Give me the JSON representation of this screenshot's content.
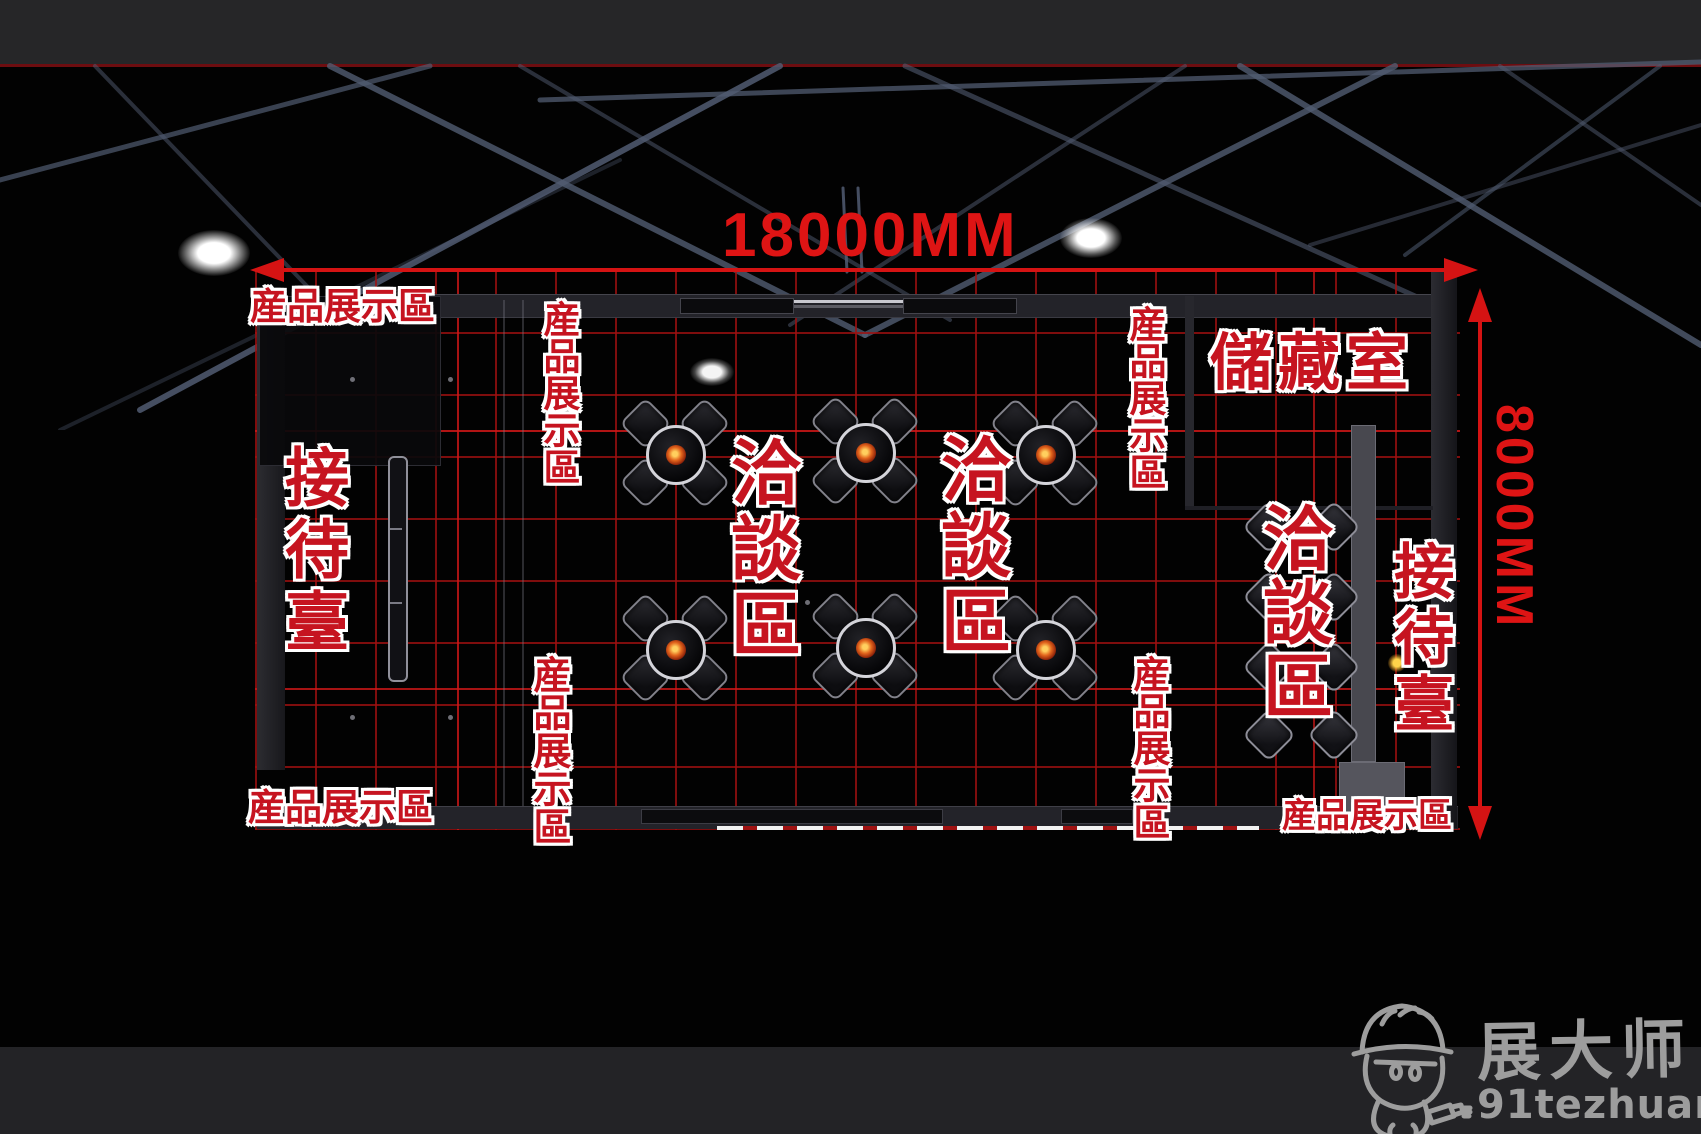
{
  "dimensions": {
    "width_label": "18000MM",
    "height_label": "8000MM"
  },
  "area_labels": [
    {
      "id": "product-display-top-left",
      "text": "産品展示區",
      "orientation": "horizontal"
    },
    {
      "id": "product-display-left-top",
      "text": "産品展示區",
      "orientation": "vertical"
    },
    {
      "id": "product-display-left-bottom",
      "text": "産品展示區",
      "orientation": "vertical"
    },
    {
      "id": "product-display-bottom-left",
      "text": "産品展示區",
      "orientation": "horizontal"
    },
    {
      "id": "product-display-right-top",
      "text": "産品展示區",
      "orientation": "vertical"
    },
    {
      "id": "product-display-right-bottom",
      "text": "産品展示區",
      "orientation": "vertical"
    },
    {
      "id": "product-display-bottom-right",
      "text": "産品展示區",
      "orientation": "horizontal"
    },
    {
      "id": "reception-desk-left",
      "text": "接待臺",
      "orientation": "vertical"
    },
    {
      "id": "reception-desk-right",
      "text": "接待臺",
      "orientation": "vertical"
    },
    {
      "id": "negotiation-area-1",
      "text": "洽談區",
      "orientation": "vertical"
    },
    {
      "id": "negotiation-area-2",
      "text": "洽談區",
      "orientation": "vertical"
    },
    {
      "id": "negotiation-area-3",
      "text": "洽談區",
      "orientation": "vertical"
    },
    {
      "id": "storage-room",
      "text": "儲藏室",
      "orientation": "horizontal"
    }
  ],
  "watermark": {
    "brand": "展大师",
    "site": "91tezhuang.com"
  },
  "colors": {
    "label_red": "#c61420",
    "label_outline": "#ffffff",
    "dimension_red": "#d51313",
    "grid_red": "#9e1010",
    "truss_gray_blue": "#56617a",
    "band_gray": "#252527",
    "watermark_gray": "#9d9d9d",
    "background": "#000000"
  }
}
